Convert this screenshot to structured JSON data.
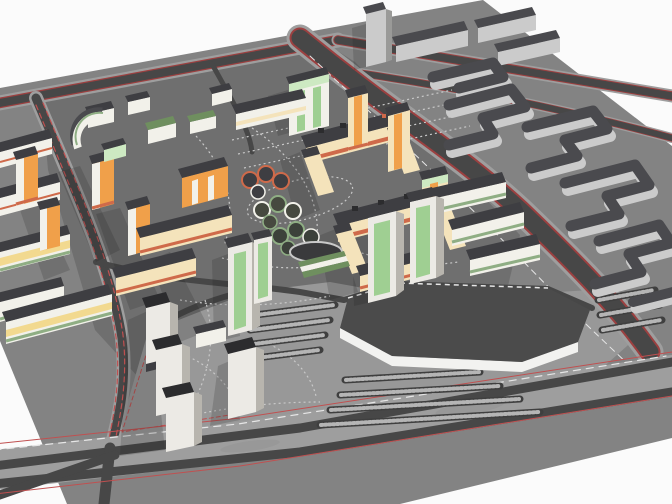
{
  "document_title": "3D city district model render",
  "scene": {
    "type": "3d-urban-model-render",
    "description": "Axonometric render of a residential microdistrict: colorful housing blocks around courtyards, white high-rise towers, a dark elevated parking deck with white retaining wall, red curb lines along roads, dotted footpaths, and plain gray context housing across the avenue.",
    "sky": "white"
  },
  "palette": {
    "background": "#fbfbfb",
    "ground": "#838383",
    "courtyard": "#6f6f6f",
    "plaza": "#989898",
    "road_asphalt": "#474747",
    "road_sidewalk": "#9e9e9e",
    "curb_red": "#9c4040",
    "marking_red": "#c05050",
    "marking_white": "#e6e6e6",
    "path_dot": "#c9c9c9",
    "deck_surface": "#4b4b4b",
    "deck_wall": "#f2f2f0",
    "parking_row": "#3f3f3f",
    "parking_stripe": "#b5b5b5",
    "roof_dark": "#3e3e42",
    "roof_deep": "#2c2c2e",
    "roof_green": "#6f8f5f",
    "base_green": "#8fae84",
    "wall_white": "#f2f1ea",
    "wall_cream": "#f4e3bb",
    "wall_yellow": "#f2d98f",
    "wall_orange": "#f0a04a",
    "accent_red": "#cf6a4a",
    "wall_mint": "#cde9c2",
    "mint_deep": "#9fcf92",
    "context_wall": "#cbcbcb",
    "context_roof": "#4a4a4e",
    "tower_white": "#eceae5",
    "tower_side": "#b8b5ae",
    "shadow": "#1a1a1a"
  },
  "inventory": {
    "roads": [
      "far-boundary-road",
      "arterial-avenue",
      "left-street",
      "bottom-boulevard",
      "service-road-right"
    ],
    "markings": {
      "curbs": "red lines",
      "lane_dashes": "white",
      "footpaths": "dotted light gray",
      "street_edge": "red dashed"
    },
    "clusters": [
      {
        "name": "residential-left",
        "colors": [
          "orange towers",
          "cream slabs",
          "red-striped white slabs",
          "yellow/green striped slabs"
        ]
      },
      {
        "name": "courtyard-u-blocks",
        "colors": [
          "cream walls",
          "red-orange base",
          "dark roofs"
        ]
      },
      {
        "name": "pavilion-pod-clusters",
        "count": 3
      },
      {
        "name": "green-white-slabs-and-towers",
        "count": 7
      },
      {
        "name": "white-highrise-towers",
        "count": 4
      },
      {
        "name": "mint-tower",
        "count": 1
      },
      {
        "name": "context-housing-right",
        "style": "gray serpentine blocks and slabs"
      },
      {
        "name": "parking-deck",
        "surface": "dark",
        "retaining_wall": "white"
      }
    ]
  }
}
